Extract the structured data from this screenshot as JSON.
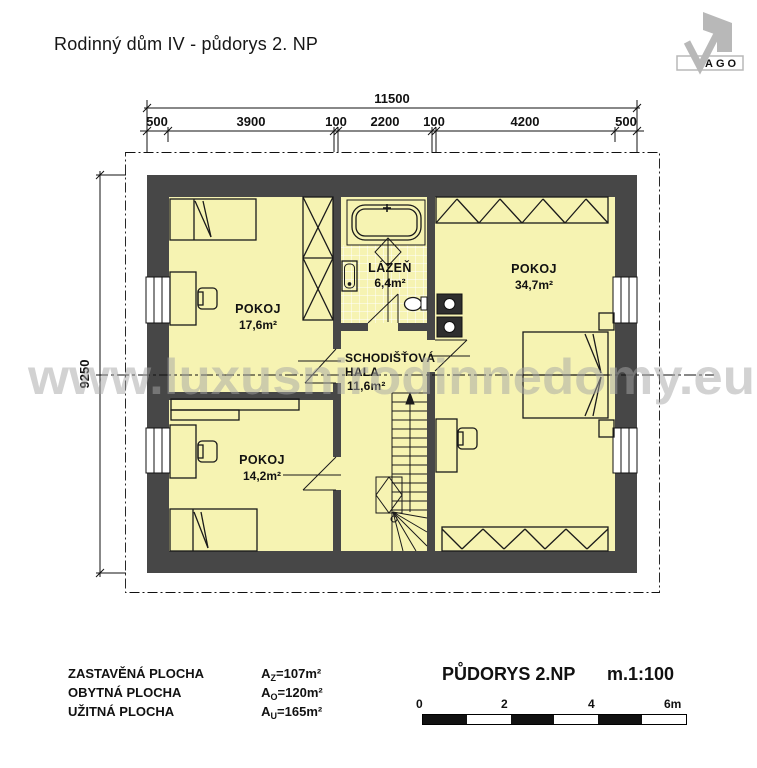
{
  "header": {
    "title": "Rodinný dům IV - půdorys 2. NP"
  },
  "logo": {
    "text": "AGO"
  },
  "dims": {
    "total": "11500",
    "side": "9250",
    "top_segments": [
      "500",
      "3900",
      "100",
      "2200",
      "100",
      "4200",
      "500"
    ]
  },
  "rooms": {
    "room1": {
      "name": "POKOJ",
      "area": "17,6m²"
    },
    "bath": {
      "name": "LÁZEŇ",
      "area": "6,4m²"
    },
    "room2": {
      "name": "POKOJ",
      "area": "34,7m²"
    },
    "hall": {
      "name_line1": "SCHODIŠŤOVÁ",
      "name_line2": "HALA",
      "area": "11,6m²"
    },
    "room3": {
      "name": "POKOJ",
      "area": "14,2m²"
    }
  },
  "watermark": {
    "text": "www.luxusnirodinnedomy.eu"
  },
  "legend": {
    "rows": [
      {
        "label": "ZASTAVĚNÁ PLOCHA",
        "sym": "A",
        "sub": "Z",
        "val": "=107m²"
      },
      {
        "label": "OBYTNÁ  PLOCHA",
        "sym": "A",
        "sub": "O",
        "val": "=120m²"
      },
      {
        "label": "UŽITNÁ  PLOCHA",
        "sym": "A",
        "sub": "U",
        "val": "=165m²"
      }
    ]
  },
  "footer": {
    "title": "PŮDORYS 2.NP",
    "scale": "m.1:100",
    "ticks": [
      "0",
      "2",
      "4",
      "6m"
    ]
  },
  "colors": {
    "wall": "#474747",
    "room_fill": "#f6f3b2",
    "watermark": "#a6a6a6"
  }
}
